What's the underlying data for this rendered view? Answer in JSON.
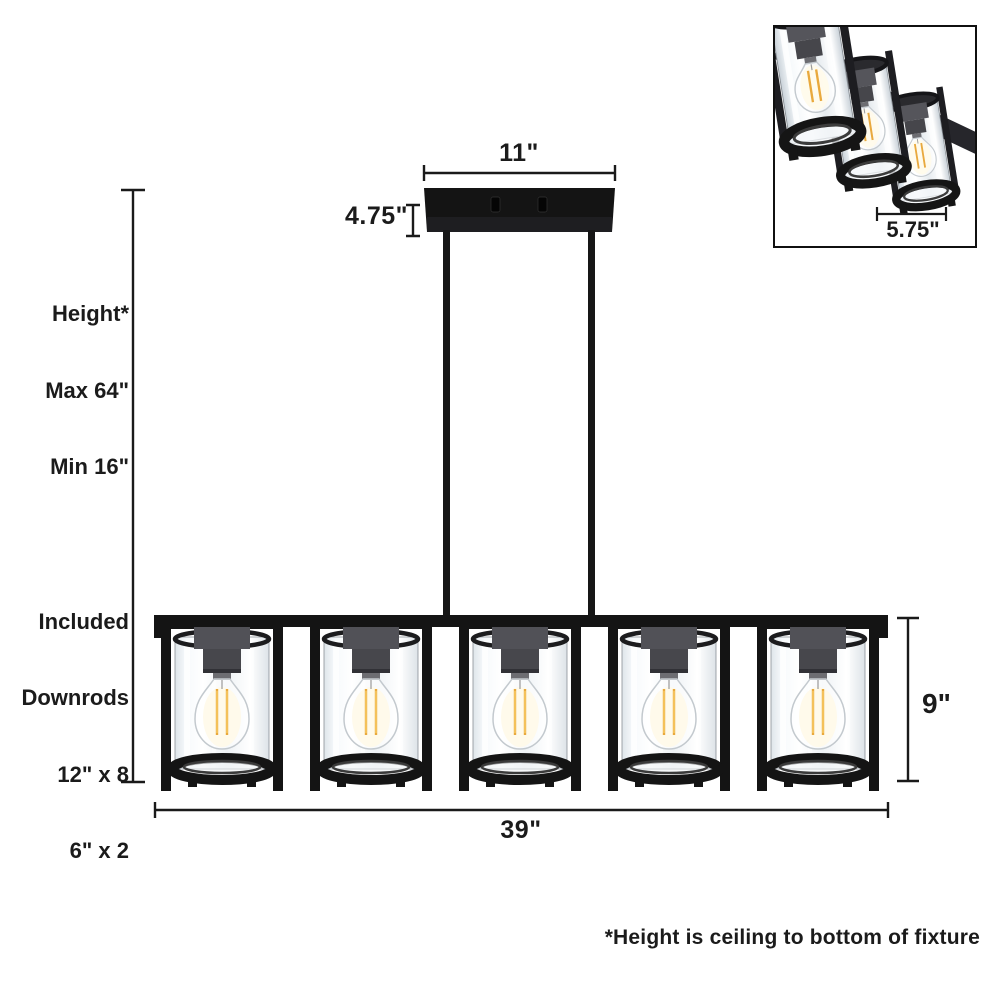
{
  "labels": {
    "canopy_width": "11\"",
    "canopy_depth": "4.75\"",
    "shade_height": "9\"",
    "fixture_length": "39\"",
    "shade_diameter": "5.75\"",
    "footnote": "*Height is ceiling to bottom of fixture"
  },
  "height_block": {
    "lines": [
      "Height*",
      "Max 64\"",
      "Min 16\""
    ]
  },
  "downrods_block": {
    "lines": [
      "Included",
      "Downrods",
      "12\" x 8",
      "6\" x 2"
    ]
  },
  "colors": {
    "fixture_black": "#141414",
    "line_color": "#1a1a1a",
    "socket_gray": "#4c4c51",
    "filament_yellow": "#e9a93d",
    "glow": "#fff3cd",
    "background": "#ffffff"
  }
}
